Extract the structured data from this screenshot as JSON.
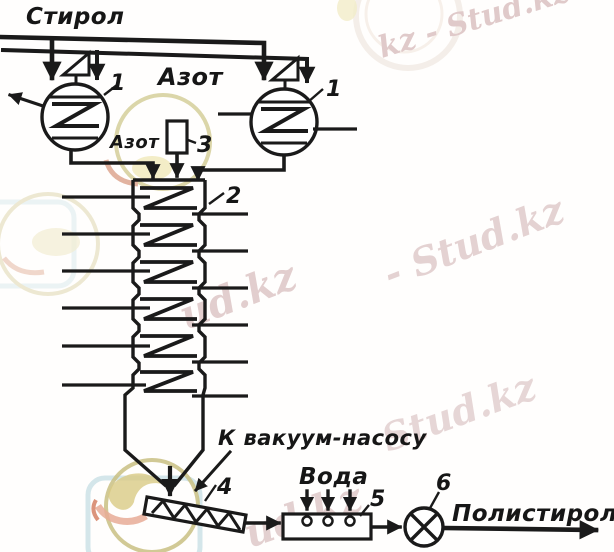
{
  "diagram": {
    "labels": {
      "styrene": "Стирол",
      "nitrogen_main": "Азот",
      "nitrogen_feed": "Азот",
      "vacuum": "К вакуум-насосу",
      "water": "Вода",
      "polystyrene": "Полистирол"
    },
    "equipment": {
      "reactor_left": "1",
      "reactor_right": "1",
      "column": "2",
      "nitrogen_box": "3",
      "screw_conveyor": "4",
      "washer": "5",
      "grinder": "6"
    }
  },
  "watermarks": {
    "top_right": "kz - Stud.kz",
    "mid_right": "- Stud.kz",
    "center": "ud.kz",
    "lower_right": "Stud.kz",
    "bottom_center": "ud.kz"
  },
  "colors": {
    "ink": "#1a1a1a",
    "background": "#ffffff",
    "watermark_text": "#e2cdcd",
    "logo_ring": "#c9c083",
    "logo_flame": "#d9cb84",
    "logo_accent": "#e8ab97",
    "logo_frame": "#cfe3e8"
  }
}
